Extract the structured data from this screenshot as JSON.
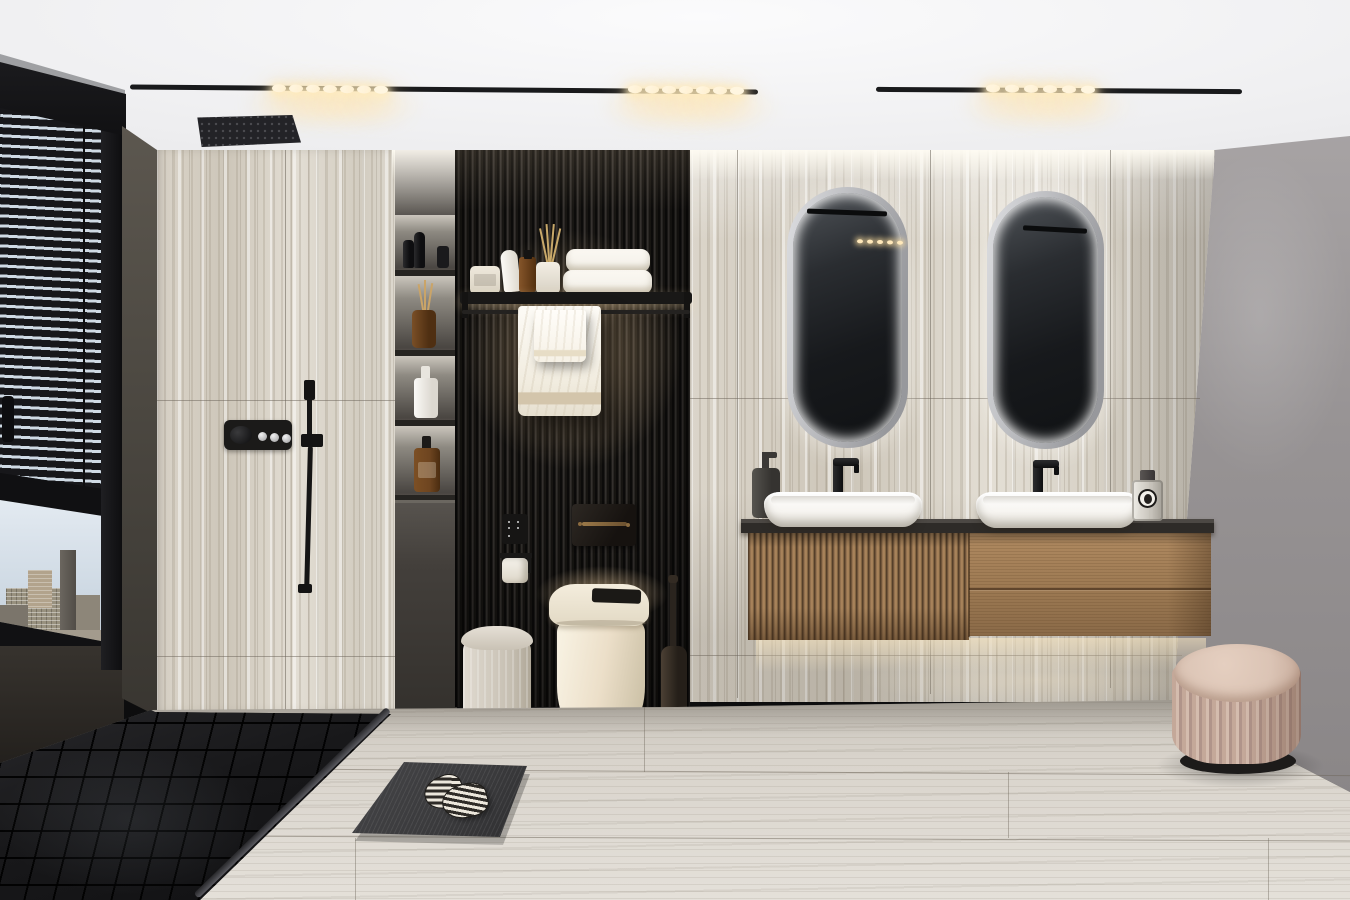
{
  "meta": {
    "kind": "photorealistic 3D interior render",
    "label": "Modern luxury bathroom with travertine walls, black slat feature wall, double floating vanity and walk-in shower",
    "width_px": 1350,
    "height_px": 900
  },
  "scene": {
    "ceiling": {
      "label": "White ceiling with two recessed black linear track lights and a black square rain shower head",
      "tracks": 2,
      "spotlight_groups": [
        7,
        7,
        6
      ],
      "rain_shower_head": "matte black square, ceiling mounted"
    },
    "window": {
      "label": "Black framed corner window with dark venetian blinds, daytime high-rise city skyline below",
      "blinds_state": "lowered over upper two-thirds",
      "view": "hazy daylight cityscape with office towers"
    },
    "shower": {
      "label": "Walk-in shower on travertine wall with black thermostatic panel, handheld shower and black mosaic tray",
      "control_buttons": 3,
      "control_knob": 1
    },
    "niche": {
      "label": "Backlit recessed shelving column with toiletries",
      "shelves": 4,
      "items": [
        "black bottles",
        "amber reed diffuser",
        "white pump bottle",
        "amber pump bottle"
      ]
    },
    "slat_wall": {
      "label": "Floor-to-ceiling black wood slat feature wall behind toilet",
      "shelf_items": [
        "cream jar",
        "white tube",
        "amber bottle",
        "ceramic reed diffuser",
        "two folded white towels"
      ],
      "hanging_towels": 2
    },
    "toilet": {
      "label": "Cream smart toilet with black sensor lid, bronze flush plate, socket panel, paper holder, pedal bin and toilet brush"
    },
    "vanity": {
      "label": "Floating oak vanity, fluted left half and smooth drawer half, black stone top",
      "basins": 2,
      "faucets": "matte black, tall spout",
      "mirrors": 2,
      "mirror_style": "pill-shaped LED backlit with chrome frame",
      "accessories": [
        "dark soap dispenser",
        "glass perfume bottle with round label"
      ]
    },
    "floor": {
      "label": "Light travertine plank floor with black mosaic shower zone, dark bath mat and striped slippers"
    },
    "pouf": {
      "label": "Blush fluted vanity stool with dark base"
    },
    "right_wall": {
      "label": "Plain warm-gray painted wall"
    }
  },
  "palette": {
    "ceiling": "#ededef",
    "track": "#191a1c",
    "glow": "#ffecc2",
    "trav": "#ded8cd",
    "joint": "#9e968a",
    "slat": "#211f1d",
    "slatHi": "#3c3835",
    "niche": "#46423e",
    "frame": "#17171a",
    "sky": "#cfdae4",
    "olive": "#4e4a43",
    "wallR": "#979394",
    "floor": "#d9d4cc",
    "mosaic": "#121213",
    "woodA": "#a8835c",
    "woodB": "#6b5138",
    "counter": "#2e2b28",
    "basin": "#f7f5f1",
    "cream": "#ecdfc9",
    "towel": "#f6f3ec",
    "beige": "#d3c5ab",
    "bronze": "#7c6344",
    "amber": "#6e4520",
    "poufA": "#c4a899",
    "poufB": "#dbc4b5",
    "mat": "#3a3a3c"
  }
}
